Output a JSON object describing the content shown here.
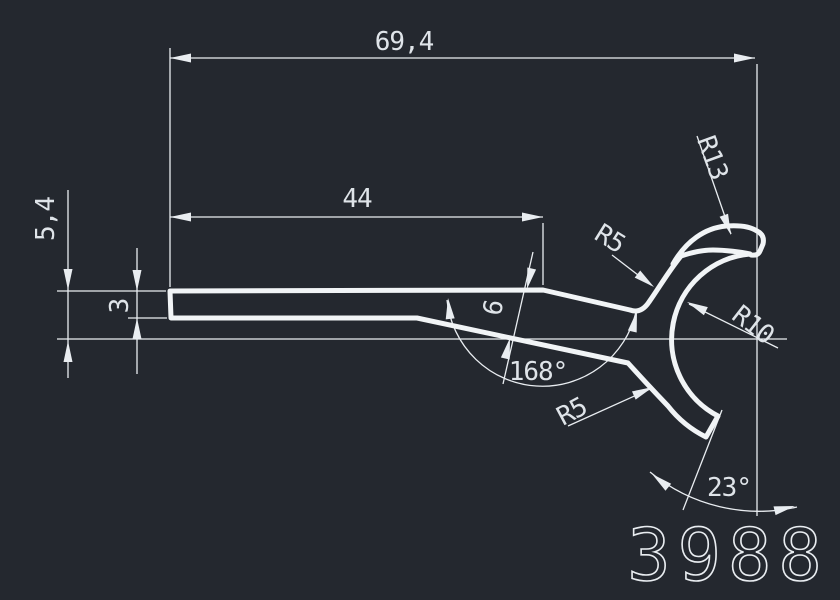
{
  "canvas": {
    "background_color": "#24282f",
    "line_color": "#e9edf1"
  },
  "part_number": "3988",
  "dimensions": {
    "overall_length": "69,4",
    "straight_length": "44",
    "left_height": "5,4",
    "bar_thickness": "3",
    "taper_width": "6",
    "bend_angle": "168°",
    "tip_angle": "23°",
    "outer_radius": "R13",
    "upper_fillet_radius": "R5",
    "inner_radius": "R10",
    "lower_fillet_radius": "R5"
  }
}
